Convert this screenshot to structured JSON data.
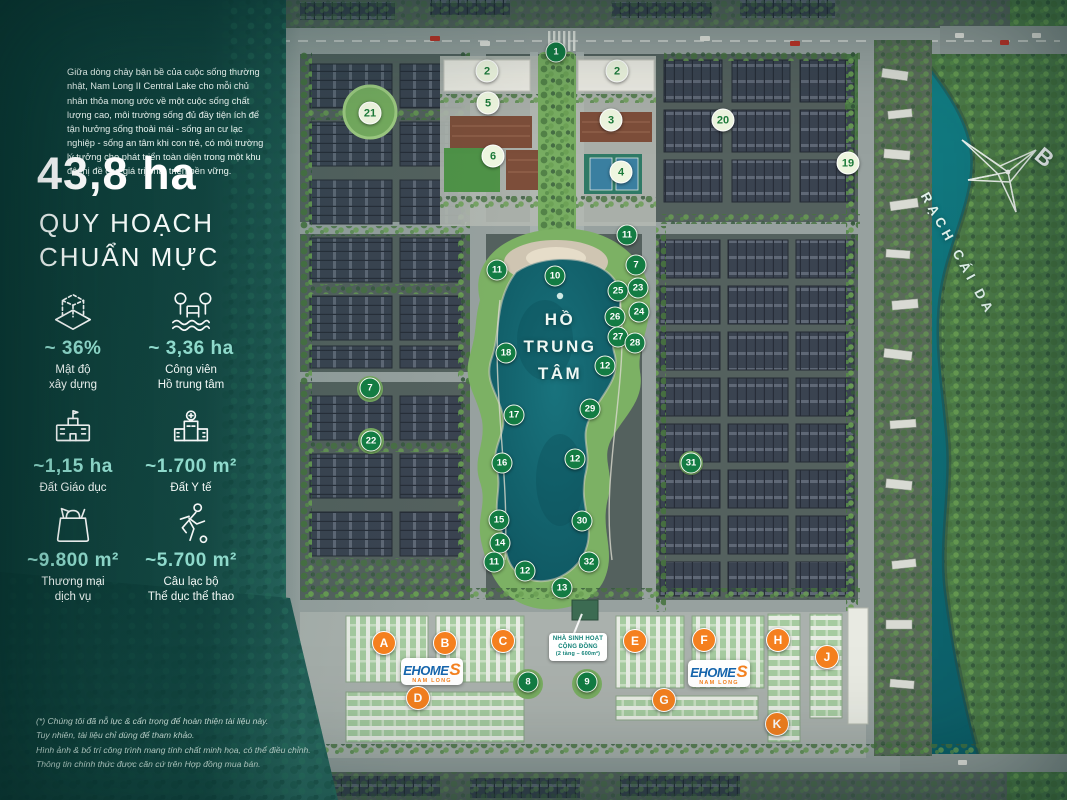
{
  "panel": {
    "intro": "Giữa dòng chảy bận bề của cuộc sống thường nhật, Nam Long II Central Lake cho mỗi chủ nhân thỏa mong ước về một cuộc sống chất lượng cao, môi trường sống đủ đầy tiện ích để tận hưởng sống thoải mái - sống an cư lạc nghiệp - sống an tâm khi con trẻ, có môi trường lý tưởng cho phát triển toàn diện trong một khu đô thị đề cao giá trị phát triển bền vững.",
    "headline_value": "43,8 ha",
    "headline_sub": "QUY HOẠCH\nCHUẨN MỰC",
    "stats": [
      {
        "icon": "density-icon",
        "value": "~ 36%",
        "label": "Mật độ\nxây dựng"
      },
      {
        "icon": "park-icon",
        "value": "~ 3,36 ha",
        "label": "Công viên\nHồ trung tâm"
      },
      {
        "icon": "school-icon",
        "value": "~1,15 ha",
        "label": "Đất Giáo dục"
      },
      {
        "icon": "medical-icon",
        "value": "~1.700 m²",
        "label": "Đất Y tế"
      },
      {
        "icon": "shopping-icon",
        "value": "~9.800 m²",
        "label": "Thương mại\ndịch vụ"
      },
      {
        "icon": "sport-icon",
        "value": "~5.700 m²",
        "label": "Câu lạc bộ\nThể dục thể thao"
      }
    ],
    "footnote": [
      "(*) Chúng tôi đã nỗ lực & cẩn trọng để hoàn thiện tài liệu này.",
      "Tuy nhiên, tài liệu chỉ dùng để tham khảo.",
      "Hình ảnh & bố trí công trình mang tính chất minh họa, có thể điều chỉnh.",
      "Thông tin chính thức được căn cứ trên Hợp đồng mua bán."
    ]
  },
  "map": {
    "lake_lines": [
      "HỒ",
      "TRUNG",
      "TÂM"
    ],
    "river_label": "RẠCH CÁI DA",
    "compass_label": "B",
    "community": {
      "line1": "NHÀ SINH HOẠT",
      "line2": "CỘNG ĐỒNG",
      "line3": "(2 tầng – 600m²)"
    },
    "ehome": {
      "word": "EHOME",
      "s": "S",
      "sub": "NAM LONG"
    },
    "markers": [
      {
        "t": "g",
        "label": "1",
        "x": 556,
        "y": 52
      },
      {
        "t": "g",
        "label": "10",
        "x": 555,
        "y": 276
      },
      {
        "t": "g",
        "label": "11",
        "x": 497,
        "y": 270
      },
      {
        "t": "g",
        "label": "18",
        "x": 506,
        "y": 353
      },
      {
        "t": "g",
        "label": "17",
        "x": 514,
        "y": 415
      },
      {
        "t": "g",
        "label": "16",
        "x": 502,
        "y": 463
      },
      {
        "t": "g",
        "label": "15",
        "x": 499,
        "y": 520
      },
      {
        "t": "g",
        "label": "14",
        "x": 500,
        "y": 543
      },
      {
        "t": "g",
        "label": "11",
        "x": 494,
        "y": 562
      },
      {
        "t": "g",
        "label": "12",
        "x": 525,
        "y": 571
      },
      {
        "t": "g",
        "label": "13",
        "x": 562,
        "y": 588
      },
      {
        "t": "g",
        "label": "7",
        "x": 370,
        "y": 388
      },
      {
        "t": "g",
        "label": "22",
        "x": 371,
        "y": 441
      },
      {
        "t": "g",
        "label": "11",
        "x": 627,
        "y": 235
      },
      {
        "t": "g",
        "label": "7",
        "x": 636,
        "y": 265
      },
      {
        "t": "g",
        "label": "25",
        "x": 618,
        "y": 291
      },
      {
        "t": "g",
        "label": "23",
        "x": 638,
        "y": 288
      },
      {
        "t": "g",
        "label": "26",
        "x": 615,
        "y": 317
      },
      {
        "t": "g",
        "label": "24",
        "x": 639,
        "y": 312
      },
      {
        "t": "g",
        "label": "27",
        "x": 618,
        "y": 337
      },
      {
        "t": "g",
        "label": "28",
        "x": 635,
        "y": 343
      },
      {
        "t": "g",
        "label": "12",
        "x": 605,
        "y": 366
      },
      {
        "t": "g",
        "label": "29",
        "x": 590,
        "y": 409
      },
      {
        "t": "g",
        "label": "12",
        "x": 575,
        "y": 459
      },
      {
        "t": "g",
        "label": "30",
        "x": 582,
        "y": 521
      },
      {
        "t": "g",
        "label": "32",
        "x": 589,
        "y": 562
      },
      {
        "t": "g",
        "label": "31",
        "x": 691,
        "y": 463
      },
      {
        "t": "g",
        "label": "8",
        "x": 528,
        "y": 682
      },
      {
        "t": "g",
        "label": "9",
        "x": 587,
        "y": 682
      },
      {
        "t": "l",
        "label": "2",
        "x": 487,
        "y": 71
      },
      {
        "t": "l",
        "label": "5",
        "x": 488,
        "y": 103
      },
      {
        "t": "l",
        "label": "6",
        "x": 493,
        "y": 156
      },
      {
        "t": "l",
        "label": "2",
        "x": 617,
        "y": 71
      },
      {
        "t": "l",
        "label": "3",
        "x": 611,
        "y": 120
      },
      {
        "t": "l",
        "label": "4",
        "x": 621,
        "y": 172
      },
      {
        "t": "l",
        "label": "21",
        "x": 370,
        "y": 113
      },
      {
        "t": "l",
        "label": "20",
        "x": 723,
        "y": 120
      },
      {
        "t": "l",
        "label": "19",
        "x": 848,
        "y": 163
      },
      {
        "t": "o",
        "label": "A",
        "x": 384,
        "y": 643
      },
      {
        "t": "o",
        "label": "B",
        "x": 445,
        "y": 643
      },
      {
        "t": "o",
        "label": "C",
        "x": 503,
        "y": 641
      },
      {
        "t": "o",
        "label": "D",
        "x": 418,
        "y": 698
      },
      {
        "t": "o",
        "label": "E",
        "x": 635,
        "y": 641
      },
      {
        "t": "o",
        "label": "F",
        "x": 704,
        "y": 640
      },
      {
        "t": "o",
        "label": "G",
        "x": 664,
        "y": 700
      },
      {
        "t": "o",
        "label": "H",
        "x": 778,
        "y": 640
      },
      {
        "t": "o",
        "label": "J",
        "x": 827,
        "y": 657
      },
      {
        "t": "o",
        "label": "K",
        "x": 777,
        "y": 724
      }
    ]
  },
  "colors": {
    "marker_green": "#137c43",
    "marker_light_text": "#1c7a39",
    "marker_orange": "#f5801f",
    "stat_value": "#8fdacc",
    "ehome_blue": "#1565ad",
    "ehome_orange": "#f58220",
    "lake": "#0d525c",
    "river": "#0c5c66"
  }
}
